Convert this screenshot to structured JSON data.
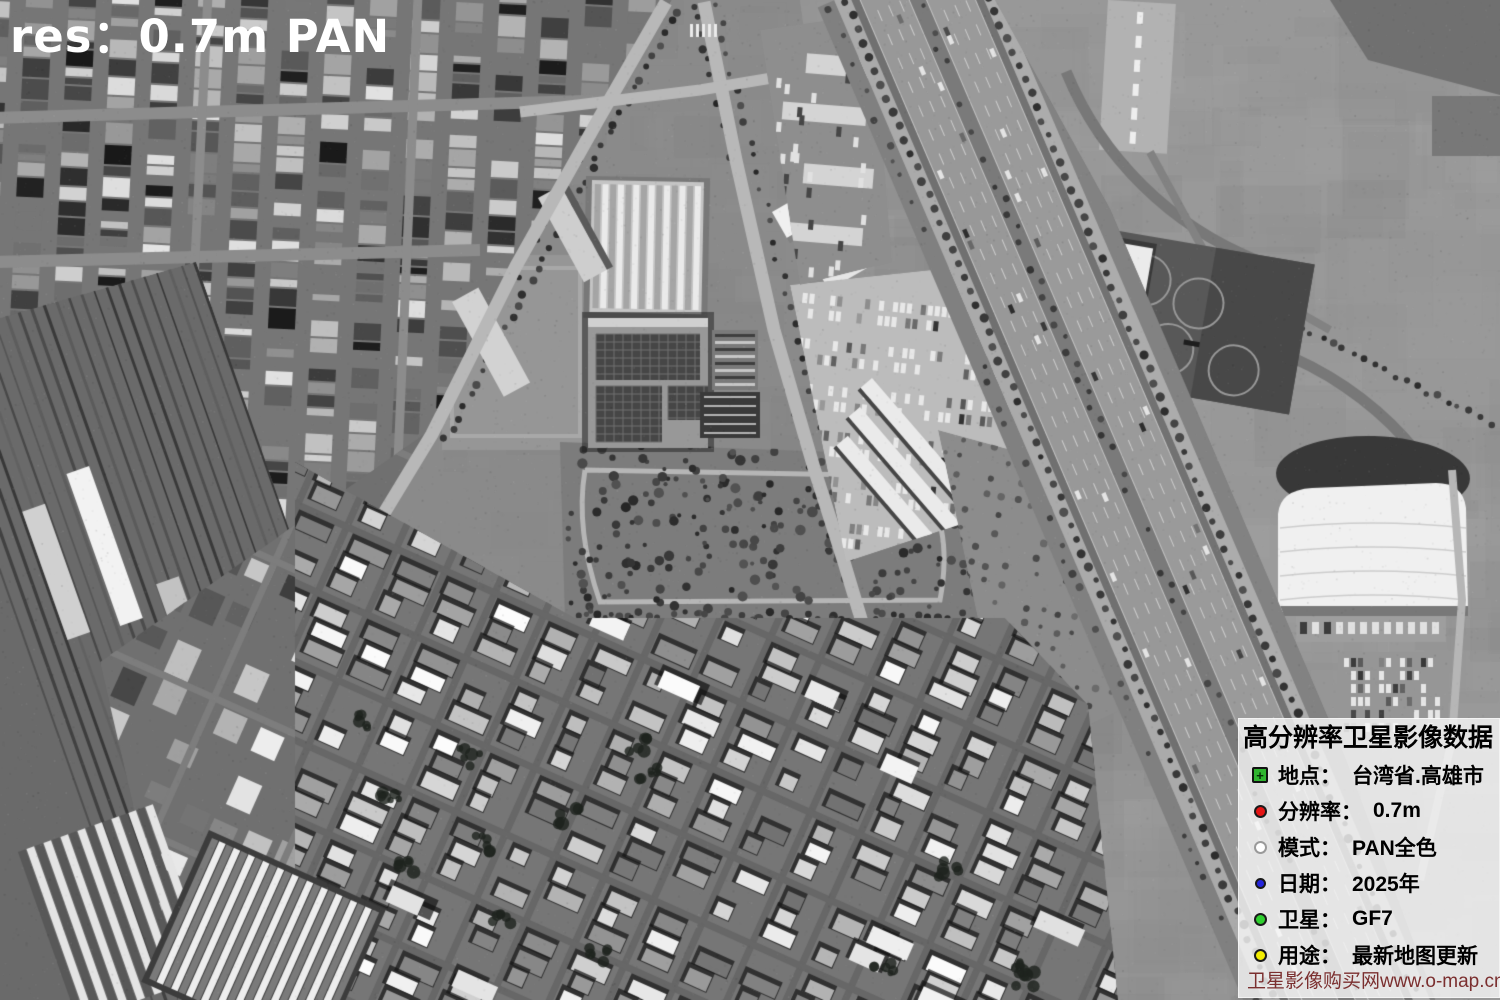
{
  "watermark": {
    "text": "res：0.7m PAN",
    "color": "#ffffff"
  },
  "info_panel": {
    "title": "高分辨率卫星影像数据",
    "rows": [
      {
        "icon": "location-marker",
        "color": "#2fb42f",
        "label": "地点：",
        "value": "台湾省.高雄市"
      },
      {
        "icon": "red-dot",
        "color": "#e41414",
        "label": "分辨率：",
        "value": "0.7m"
      },
      {
        "icon": "white-dot",
        "color": "#ffffff",
        "label": "模式：",
        "value": "PAN全色"
      },
      {
        "icon": "blue-dot",
        "color": "#2424dc",
        "label": "日期：",
        "value": "2025年"
      },
      {
        "icon": "green-dot",
        "color": "#2fd02f",
        "label": "卫星：",
        "value": "GF7"
      },
      {
        "icon": "yellow-dot",
        "color": "#f2ec00",
        "label": "用途：",
        "value": "最新地图更新"
      }
    ],
    "footer": {
      "text": "卫星影像购买网www.o-map.cn",
      "color": "#7b2f2f"
    }
  }
}
